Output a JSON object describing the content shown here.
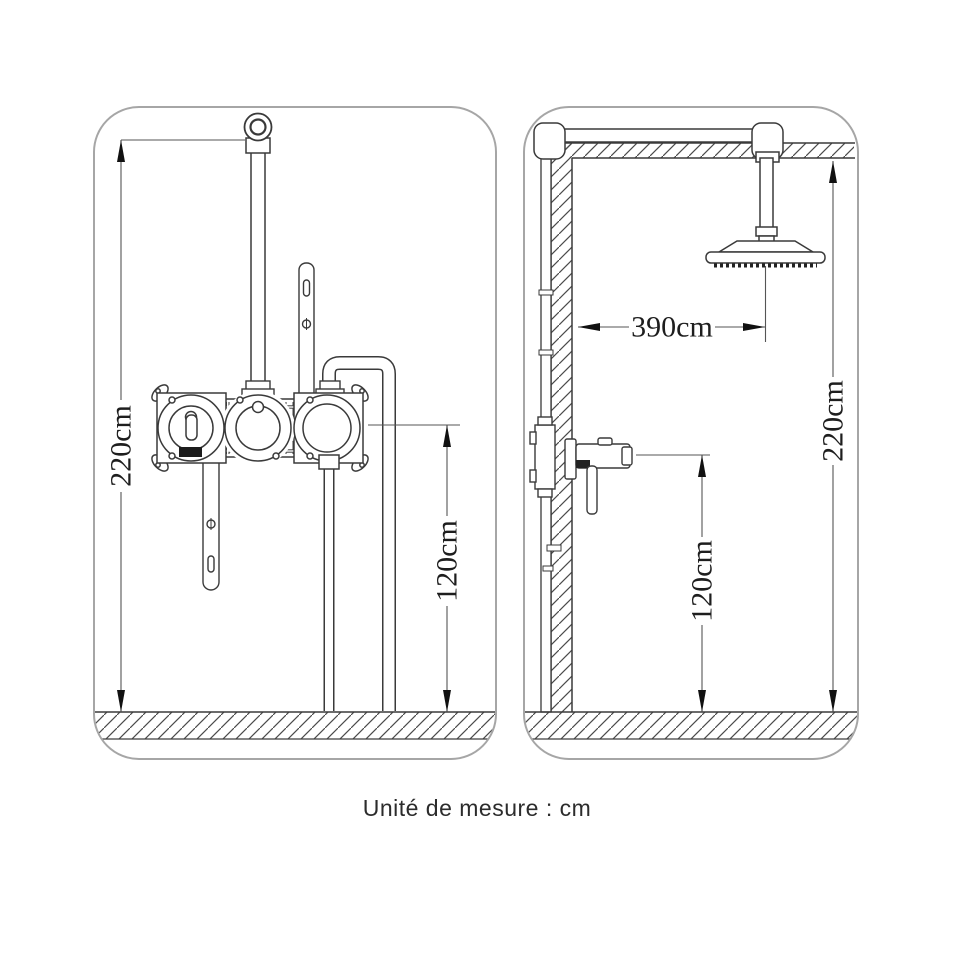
{
  "caption": "Unité de mesure : cm",
  "colors": {
    "background": "#ffffff",
    "drawing_line": "#3a3a3a",
    "dimension_line": "#555555",
    "arrow": "#111111",
    "panel_border": "#a6a6a6"
  },
  "views": {
    "front": {
      "title": "front-view",
      "dimensions": {
        "total_height": "220cm",
        "valve_height": "120cm"
      }
    },
    "side": {
      "title": "side-view",
      "dimensions": {
        "head_offset": "390cm",
        "total_height": "220cm",
        "valve_height": "120cm"
      }
    }
  }
}
